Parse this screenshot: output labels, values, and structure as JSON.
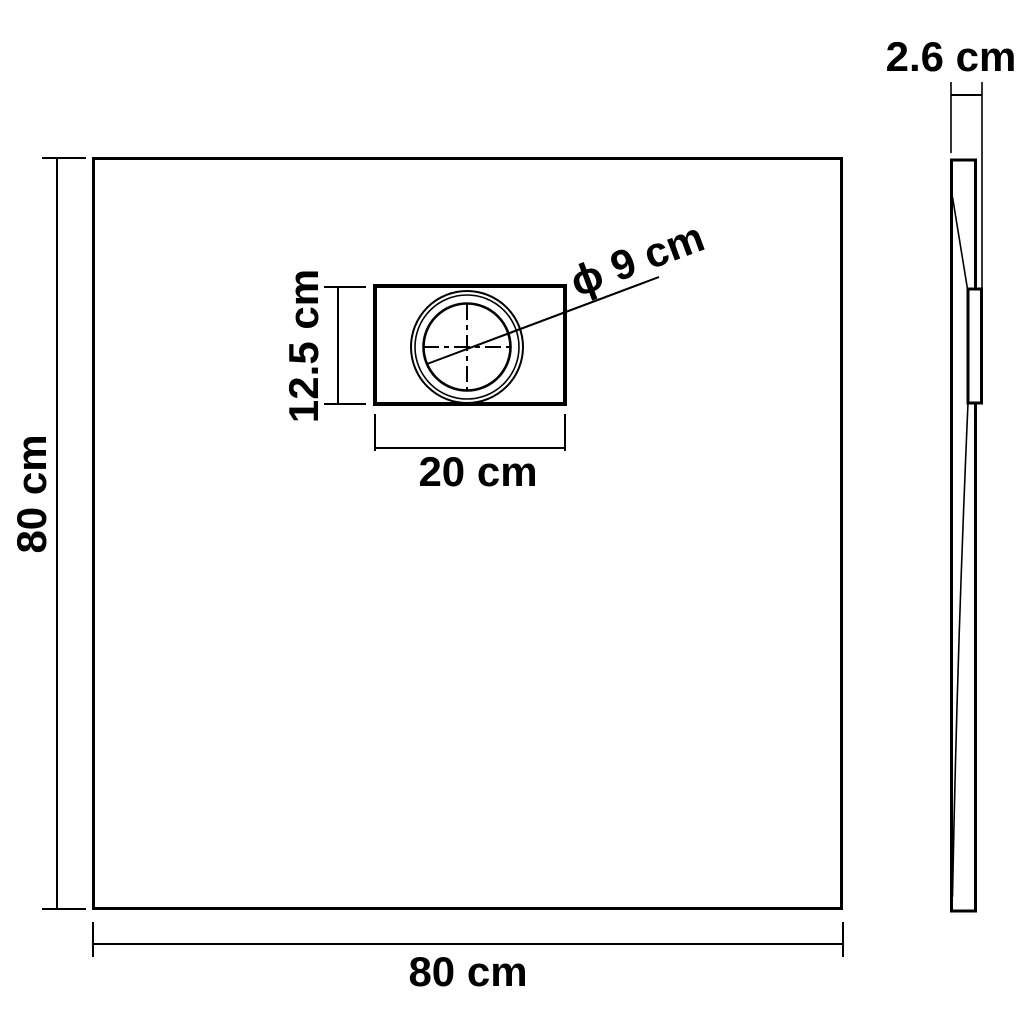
{
  "canvas": {
    "background": "#ffffff",
    "ink": "#000000"
  },
  "plan_view": {
    "height_label": "80 cm",
    "width_label": "80 cm",
    "drain_box_height_label": "12.5 cm",
    "drain_box_width_label": "20 cm",
    "drain_diameter_label": "ϕ 9 cm"
  },
  "side_view": {
    "thickness_label": "2.6 cm"
  }
}
